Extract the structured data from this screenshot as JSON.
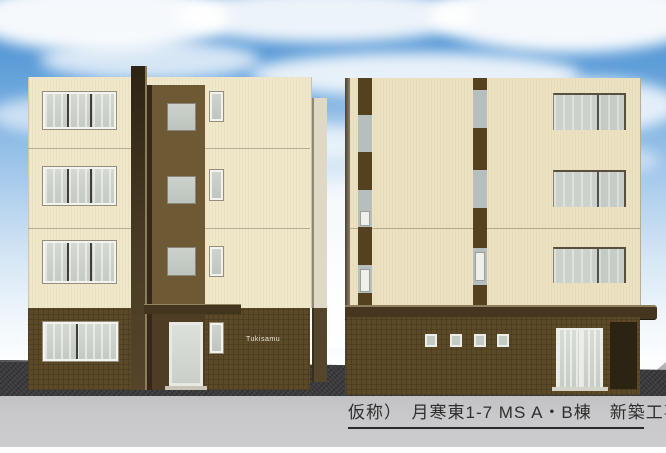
{
  "caption": {
    "text": "仮称）　月寒東1-7 MS A・B棟　新築工事"
  },
  "building_a": {
    "nameplate": "Tukisamu"
  },
  "palette": {
    "sky_top": "#3e82c8",
    "cloud": "#ffffff",
    "cream_wall": "#ece2c2",
    "dark_brown_core": "#3a2d1a",
    "base_brown_wall": "#5b4928",
    "accent_gray_panel": "#b7bfbe",
    "window_glass": "#c7cec6",
    "window_frame_white": "#f3f3ef",
    "asphalt": "#3b3b3d",
    "road_gray": "#c6c6c8",
    "caption_text": "#2e2e2e"
  }
}
